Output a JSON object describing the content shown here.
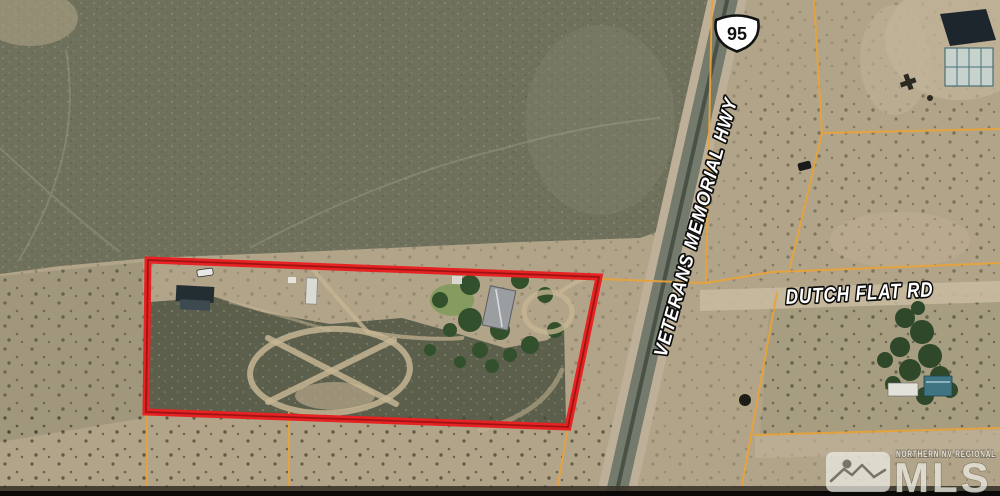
{
  "map": {
    "type": "aerial-parcel-map",
    "shield": "95",
    "roads": {
      "highway_label": "VETERANS MEMORIAL HWY",
      "cross_label": "DUTCH FLAT RD"
    },
    "watermark": {
      "region": "NORTHERN NV REGIONAL",
      "brand": "MLS"
    },
    "colors": {
      "boundary_red": "#e62222",
      "boundary_red_dark": "#9e1414",
      "parcel_line_orange": "#e8a33c",
      "scrub_dark": "#6f715d",
      "desert_tan": "#b2a489",
      "road_grey": "#747b6c"
    },
    "features": {
      "subject_parcel": "red-outlined parcel with buildings, trees and oval dirt track",
      "neighbor_southeast": "tree-shaded property with teal-roof buildings",
      "neighbor_northeast": "dark panel array and light grid structure"
    }
  }
}
